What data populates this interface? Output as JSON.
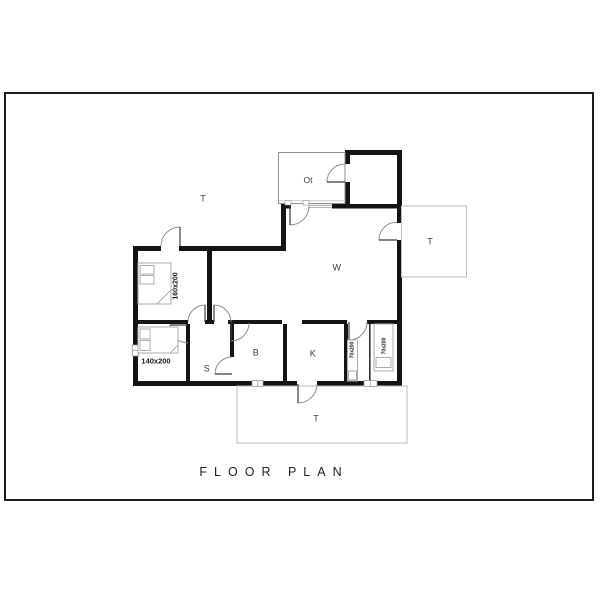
{
  "plan": {
    "title": "FLOOR PLAN",
    "rooms": [
      {
        "id": "ot",
        "label": "Ot"
      },
      {
        "id": "w",
        "label": "W"
      },
      {
        "id": "b",
        "label": "B"
      },
      {
        "id": "k",
        "label": "K"
      },
      {
        "id": "s",
        "label": "S"
      }
    ],
    "terraces": [
      {
        "id": "terrace-top-left",
        "label": "T"
      },
      {
        "id": "terrace-right",
        "label": "T"
      },
      {
        "id": "terrace-bottom",
        "label": "T"
      }
    ],
    "beds": [
      {
        "id": "bed-1",
        "size": "160x200"
      },
      {
        "id": "bed-2",
        "size": "140x200"
      },
      {
        "id": "bed-3",
        "size": "70x200"
      },
      {
        "id": "bed-4",
        "size": "70x200"
      }
    ],
    "colors": {
      "wall": "#141414",
      "thin_outline": "#bdbdbd",
      "door_arc": "#8d8d8d",
      "text": "#333333"
    }
  }
}
